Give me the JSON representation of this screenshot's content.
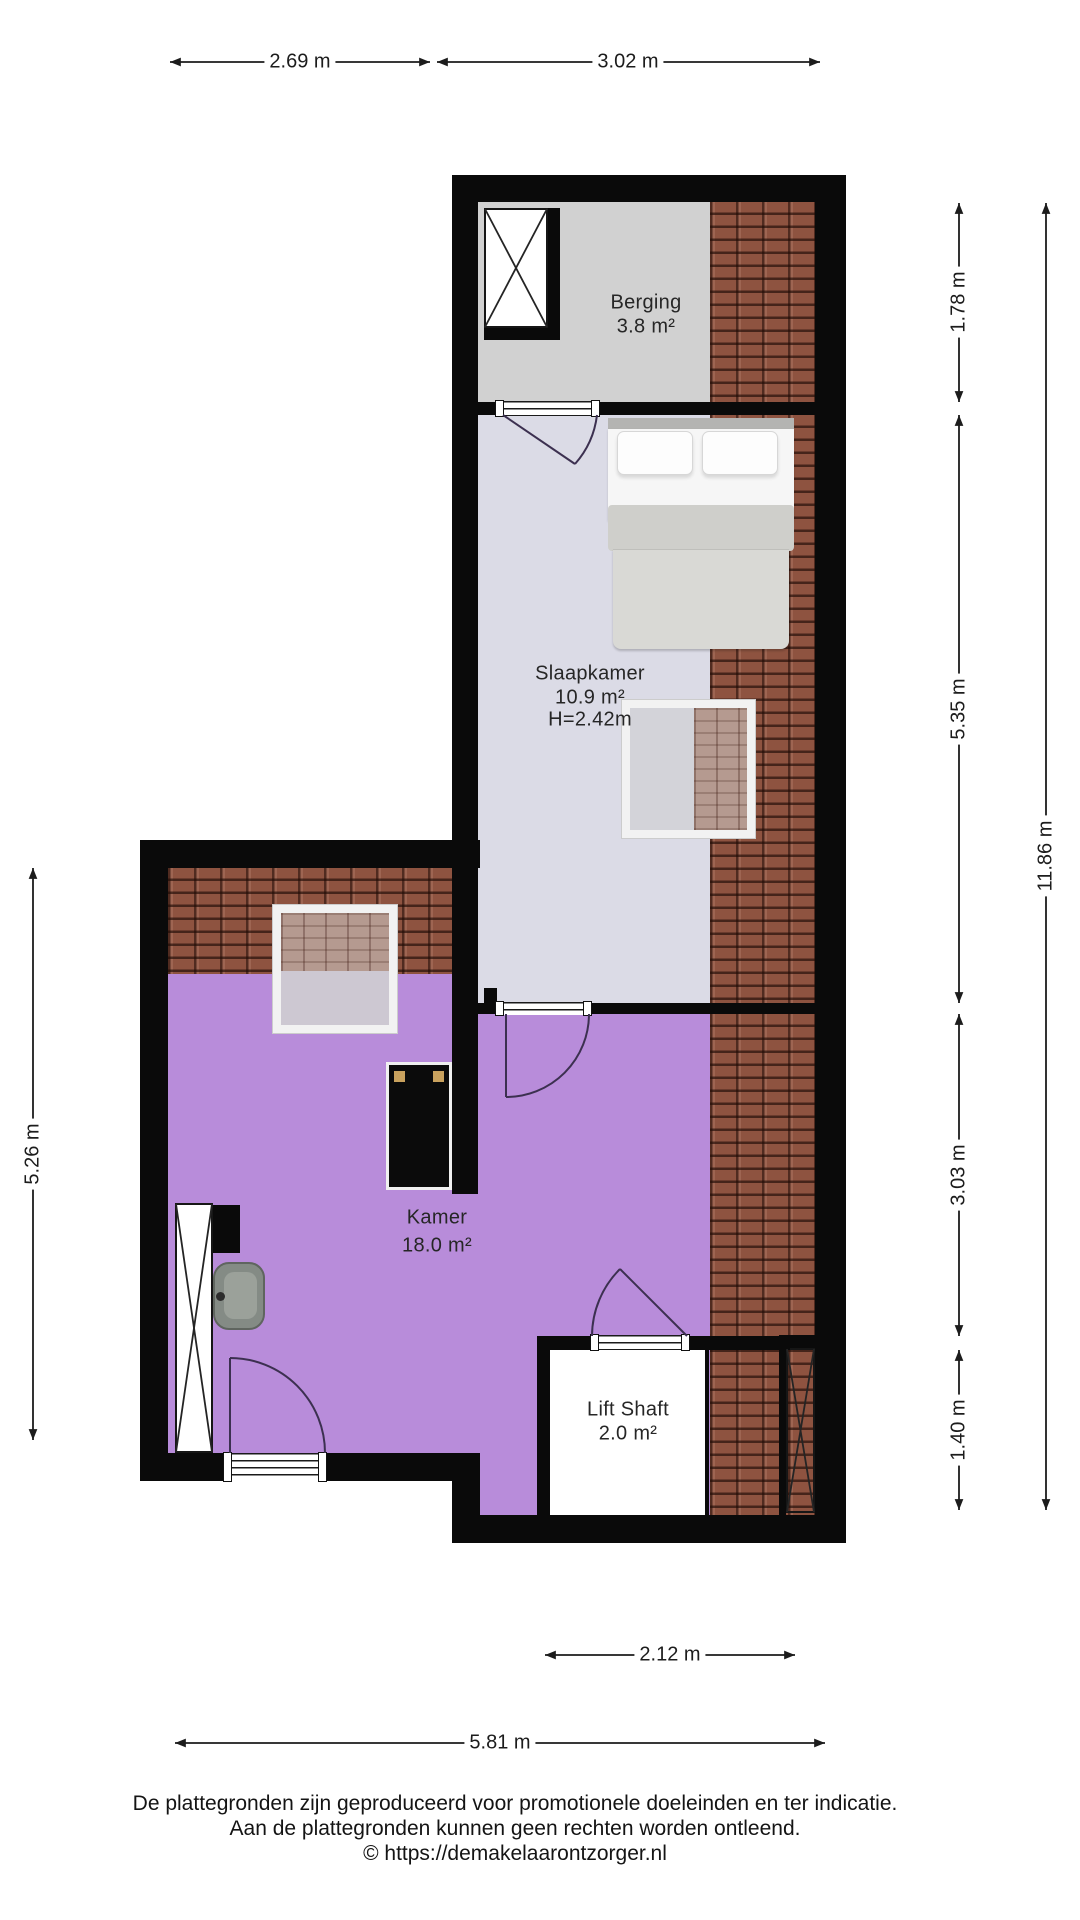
{
  "rooms": {
    "berging": {
      "name": "Berging",
      "area": "3.8 m²"
    },
    "slaapkamer": {
      "name": "Slaapkamer",
      "area": "10.9 m²",
      "ceiling_height": "H=2.42m"
    },
    "kamer": {
      "name": "Kamer",
      "area": "18.0 m²"
    },
    "lift_shaft": {
      "name": "Lift Shaft",
      "area": "2.0 m²"
    }
  },
  "dimensions": {
    "top_left_width": "2.69 m",
    "top_right_width": "3.02 m",
    "right_berging": "1.78 m",
    "right_slaapkamer": "5.35 m",
    "right_kamer": "3.03 m",
    "right_lift": "1.40 m",
    "right_total": "11.86 m",
    "left_kamer": "5.26 m",
    "bottom_lift": "2.12 m",
    "bottom_total": "5.81 m"
  },
  "footer": {
    "line1": "De plattegronden zijn geproduceerd voor promotionele doeleinden en ter indicatie.",
    "line2": "Aan de plattegronden kunnen geen rechten worden ontleend.",
    "line3": "© https://demakelaarontzorger.nl"
  },
  "colors": {
    "wall": "#0a0a0a",
    "kamer_floor": "#b88cda",
    "slaapkamer_floor": "#dbdbe6",
    "berging_floor": "#d1d1d1",
    "lift_floor": "#ffffff",
    "roof_tiles": "#8e5340",
    "dimension_text": "#1c1c1c"
  }
}
